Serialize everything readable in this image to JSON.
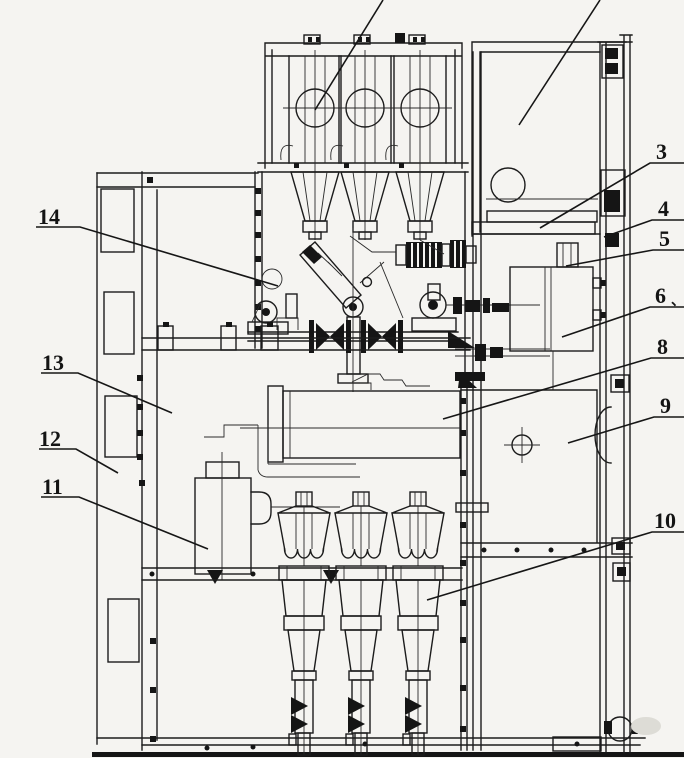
{
  "page": {
    "background": "#f5f4f1",
    "ink": "#1c1c1c"
  },
  "drawing": {
    "kind": "technical sectional line drawing (scanned)",
    "subject": "metal-enclosed switchgear cabinet, side section view",
    "offscreen_leader_lines": 2,
    "callouts": [
      {
        "label": "3"
      },
      {
        "label": "4"
      },
      {
        "label": "5"
      },
      {
        "label": "6",
        "suffix": "、"
      },
      {
        "label": "8"
      },
      {
        "label": "9"
      },
      {
        "label": "10"
      },
      {
        "label": "11"
      },
      {
        "label": "12"
      },
      {
        "label": "13"
      },
      {
        "label": "14"
      }
    ]
  }
}
